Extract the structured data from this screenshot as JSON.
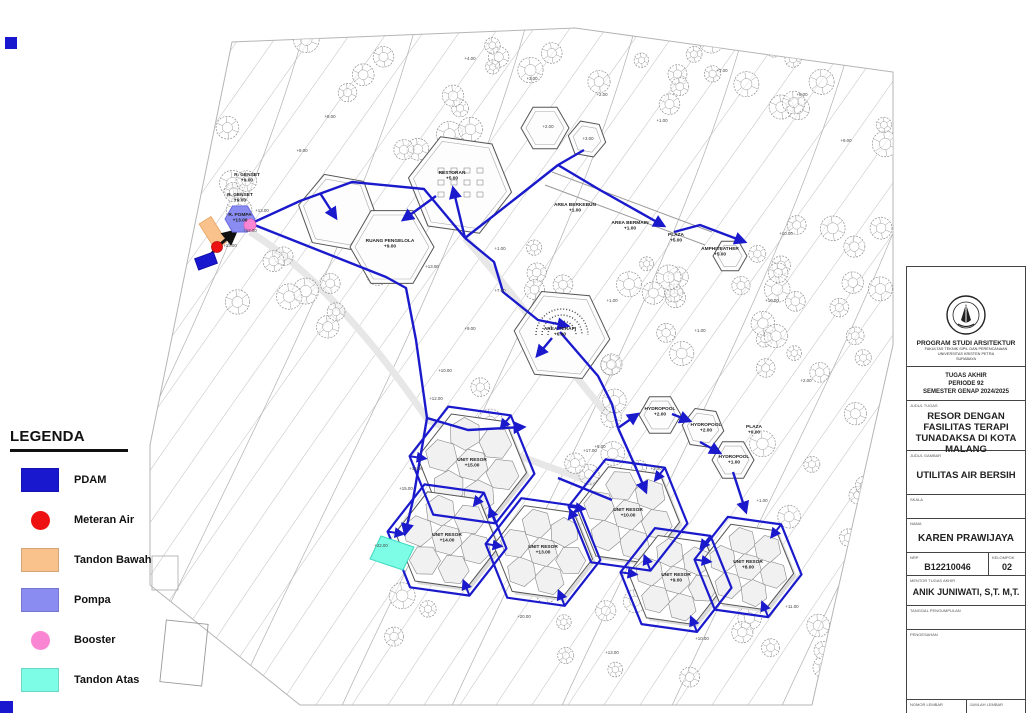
{
  "accent": {
    "pipe_blue": "#1a1acc",
    "pdam_blue": "#1a18cf",
    "meter_red": "#ee1111",
    "tandon_bawah_orange": "#f9c28c",
    "pompa_purple": "#8a8cf2",
    "booster_pink": "#fa85d3",
    "tandon_atas_cyan": "#7dfce6"
  },
  "legend": {
    "title": "LEGENDA",
    "items": [
      {
        "label": "PDAM",
        "shape": "rect",
        "color": "#1a18cf"
      },
      {
        "label": "Meteran Air",
        "shape": "circle",
        "color": "#ee1111"
      },
      {
        "label": "Tandon Bawah",
        "shape": "rect",
        "color": "#f9c28c"
      },
      {
        "label": "Pompa",
        "shape": "rect",
        "color": "#8a8cf2"
      },
      {
        "label": "Booster",
        "shape": "circle",
        "color": "#fa85d3"
      },
      {
        "label": "Tandon Atas",
        "shape": "rect",
        "color": "#7dfce6"
      },
      {
        "label": "Aliran Air",
        "shape": "line",
        "color": "#3a3ae0"
      }
    ]
  },
  "title_block": {
    "institution": {
      "program": "PROGRAM STUDI ARSITEKTUR",
      "faculty": "FAKULTAS TEKNIK SIPIL DAN PERENCANAAN",
      "university": "UNIVERSITAS KRISTEN PETRA",
      "city": "SURABAYA"
    },
    "period": {
      "line1": "TUGAS AKHIR",
      "line2": "PERIODE 92",
      "line3": "SEMESTER GENAP 2024/2025"
    },
    "judul_tugas_label": "JUDUL TUGAS",
    "judul_tugas": "RESOR DENGAN FASILITAS TERAPI TUNADAKSA DI KOTA MALANG",
    "judul_gambar_label": "JUDUL GAMBAR",
    "judul_gambar": "UTILITAS AIR BERSIH",
    "skala_label": "SKALA",
    "nama_label": "NAMA",
    "nama": "KAREN PRAWIJAYA",
    "nrp_label": "NRP",
    "nrp": "B12210046",
    "kelompok_label": "KELOMPOK",
    "kelompok": "02",
    "mentor_label": "MENTOR TUGAS AKHIR",
    "mentor": "ANIK JUNIWATI, S,T. M,T.",
    "tanggal_label": "TANGGAL PENGUMPULAN",
    "pengesahan_label": "PENGESAHAN",
    "nomor_label": "NOMOR LEMBAR",
    "jumlah_label": "JUMLAH LEMBAR"
  },
  "site": {
    "labels": [
      {
        "t": "R. GENSET",
        "t2": "+9.00",
        "x": 247,
        "y": 176,
        "cls": "b"
      },
      {
        "t": "R. GENSET",
        "t2": "+9.00",
        "x": 240,
        "y": 196,
        "cls": "b"
      },
      {
        "t": "R. POMPA",
        "t2": "+13.00",
        "x": 240,
        "y": 216,
        "cls": "b"
      },
      {
        "t": "RESTORAN",
        "t2": "+5.00",
        "x": 452,
        "y": 174,
        "cls": "b"
      },
      {
        "t": "RUANG PENGELOLA",
        "t2": "+9.00",
        "x": 390,
        "y": 242,
        "cls": "b"
      },
      {
        "t": "AREA TERAPI",
        "t2": "+6.00",
        "x": 560,
        "y": 330,
        "cls": "b"
      },
      {
        "t": "PLAZA",
        "t2": "+5.00",
        "x": 676,
        "y": 236,
        "cls": "b"
      },
      {
        "t": "AMPHITEATHER",
        "t2": "+5.00",
        "x": 720,
        "y": 250,
        "cls": "b"
      },
      {
        "t": "AREA BERKEBUN",
        "t2": "+1.00",
        "x": 575,
        "y": 206,
        "cls": "b"
      },
      {
        "t": "AREA BERMAIN",
        "t2": "+1.00",
        "x": 630,
        "y": 224,
        "cls": "b"
      },
      {
        "t": "HYDROPOOL",
        "t2": "+2.00",
        "x": 660,
        "y": 410,
        "cls": "b"
      },
      {
        "t": "HYDROPOOL",
        "t2": "+2.00",
        "x": 706,
        "y": 426,
        "cls": "b"
      },
      {
        "t": "HYDROPOOL",
        "t2": "+1.00",
        "x": 734,
        "y": 458,
        "cls": "b"
      },
      {
        "t": "PLAZA",
        "t2": "+0.00",
        "x": 754,
        "y": 428,
        "cls": "b"
      },
      {
        "t": "UNIT RESOR",
        "t2": "+15.00",
        "x": 472,
        "y": 461,
        "cls": "b"
      },
      {
        "t": "UNIT RESOR",
        "t2": "+14.00",
        "x": 447,
        "y": 536,
        "cls": "b"
      },
      {
        "t": "UNIT RESOR",
        "t2": "+13.00",
        "x": 543,
        "y": 548,
        "cls": "b"
      },
      {
        "t": "UNIT RESOR",
        "t2": "+10.00",
        "x": 628,
        "y": 511,
        "cls": "b"
      },
      {
        "t": "UNIT RESOR",
        "t2": "+9.00",
        "x": 676,
        "y": 576,
        "cls": "b"
      },
      {
        "t": "UNIT RESOR",
        "t2": "+8.00",
        "x": 748,
        "y": 563,
        "cls": "b"
      },
      {
        "t": "+22.00",
        "x": 381,
        "y": 547,
        "cls": "e"
      },
      {
        "t": "+13.00",
        "x": 262,
        "y": 212,
        "cls": "e"
      },
      {
        "t": "+12.00",
        "x": 250,
        "y": 232,
        "cls": "e"
      },
      {
        "t": "+13.00",
        "x": 230,
        "y": 247,
        "cls": "e"
      },
      {
        "t": "+8.00",
        "x": 330,
        "y": 118,
        "cls": "e"
      },
      {
        "t": "+9.00",
        "x": 302,
        "y": 152,
        "cls": "e"
      },
      {
        "t": "+4.00",
        "x": 470,
        "y": 60,
        "cls": "e"
      },
      {
        "t": "+3.00",
        "x": 532,
        "y": 80,
        "cls": "e"
      },
      {
        "t": "+2.00",
        "x": 602,
        "y": 96,
        "cls": "e"
      },
      {
        "t": "+2.00",
        "x": 548,
        "y": 128,
        "cls": "e"
      },
      {
        "t": "+3.00",
        "x": 588,
        "y": 140,
        "cls": "e"
      },
      {
        "t": "+1.00",
        "x": 662,
        "y": 122,
        "cls": "e"
      },
      {
        "t": "+7.00",
        "x": 722,
        "y": 72,
        "cls": "e"
      },
      {
        "t": "+8.00",
        "x": 802,
        "y": 96,
        "cls": "e"
      },
      {
        "t": "+9.00",
        "x": 846,
        "y": 142,
        "cls": "e"
      },
      {
        "t": "+10.00",
        "x": 786,
        "y": 235,
        "cls": "e"
      },
      {
        "t": "+1.00",
        "x": 500,
        "y": 250,
        "cls": "e"
      },
      {
        "t": "+13.00",
        "x": 432,
        "y": 268,
        "cls": "e"
      },
      {
        "t": "+7.00",
        "x": 500,
        "y": 292,
        "cls": "e"
      },
      {
        "t": "+9.00",
        "x": 470,
        "y": 330,
        "cls": "e"
      },
      {
        "t": "+10.00",
        "x": 445,
        "y": 372,
        "cls": "e"
      },
      {
        "t": "+12.00",
        "x": 436,
        "y": 400,
        "cls": "e"
      },
      {
        "t": "+1.00",
        "x": 612,
        "y": 302,
        "cls": "e"
      },
      {
        "t": "+1.00",
        "x": 700,
        "y": 332,
        "cls": "e"
      },
      {
        "t": "+10.00",
        "x": 772,
        "y": 302,
        "cls": "e"
      },
      {
        "t": "+2.00",
        "x": 806,
        "y": 382,
        "cls": "e"
      },
      {
        "t": "+1.00",
        "x": 762,
        "y": 502,
        "cls": "e"
      },
      {
        "t": "+11.00",
        "x": 792,
        "y": 608,
        "cls": "e"
      },
      {
        "t": "+10.00",
        "x": 702,
        "y": 640,
        "cls": "e"
      },
      {
        "t": "+13.00",
        "x": 612,
        "y": 654,
        "cls": "e"
      },
      {
        "t": "+20.00",
        "x": 524,
        "y": 618,
        "cls": "e"
      },
      {
        "t": "+16.00",
        "x": 416,
        "y": 470,
        "cls": "e"
      },
      {
        "t": "+15.00",
        "x": 406,
        "y": 490,
        "cls": "e"
      },
      {
        "t": "+17.00",
        "x": 590,
        "y": 452,
        "cls": "e"
      },
      {
        "t": "+3.00",
        "x": 656,
        "y": 470,
        "cls": "e"
      },
      {
        "t": "+5.00",
        "x": 600,
        "y": 448,
        "cls": "e"
      }
    ]
  }
}
